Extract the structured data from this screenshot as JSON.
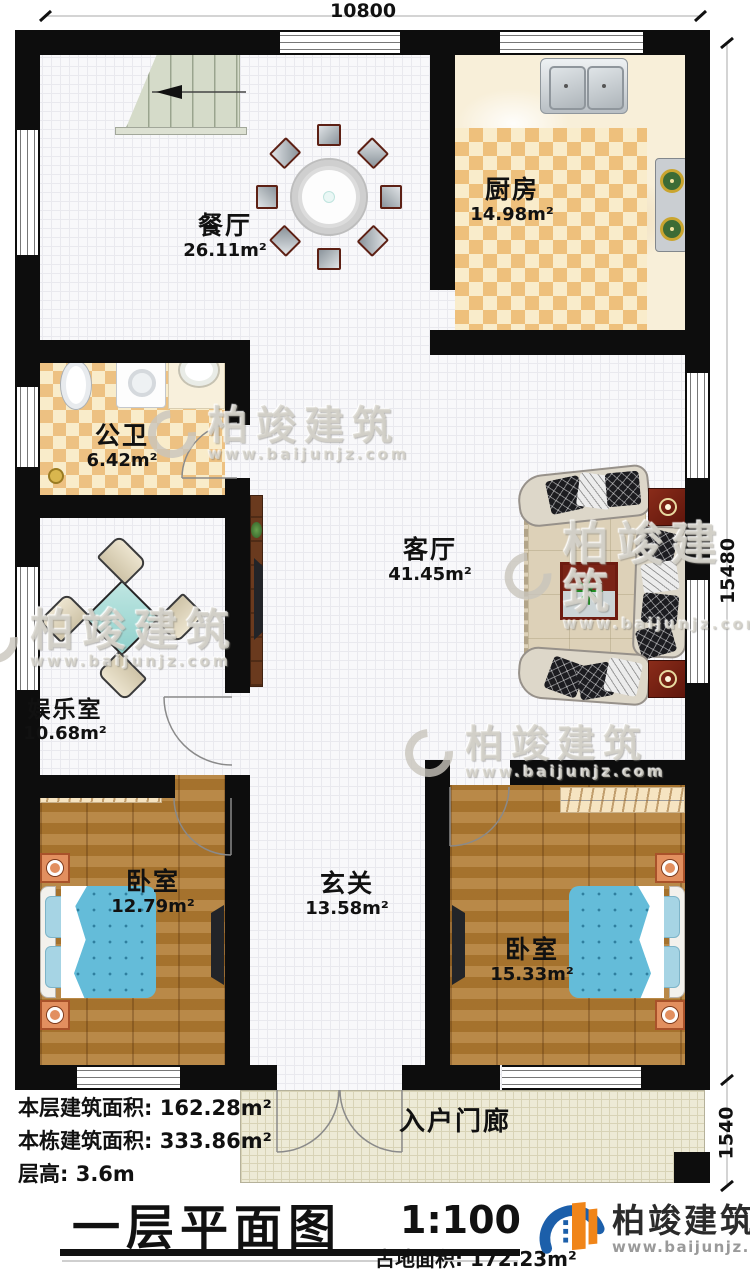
{
  "dimensions": {
    "top": "10800",
    "right": "15480",
    "porch": "1540"
  },
  "rooms": {
    "dining": {
      "name": "餐厅",
      "area": "26.11m²"
    },
    "kitchen": {
      "name": "厨房",
      "area": "14.98m²"
    },
    "bathroom": {
      "name": "公卫",
      "area": "6.42m²"
    },
    "living": {
      "name": "客厅",
      "area": "41.45m²"
    },
    "entertainment": {
      "name": "娱乐室",
      "area": "10.68m²"
    },
    "bedroom_left": {
      "name": "卧室",
      "area": "12.79m²"
    },
    "foyer": {
      "name": "玄关",
      "area": "13.58m²"
    },
    "bedroom_right": {
      "name": "卧室",
      "area": "15.33m²"
    },
    "porch": {
      "name": "入户门廊"
    }
  },
  "info": {
    "floor_area": {
      "label": "本层建筑面积:",
      "value": "162.28m²"
    },
    "building_area": {
      "label": "本栋建筑面积:",
      "value": "333.86m²"
    },
    "floor_height": {
      "label": "层高:",
      "value": "3.6m"
    },
    "land_area": {
      "label": "占地面积:",
      "value": "172.23m²"
    }
  },
  "title": {
    "text": "一层平面图",
    "scale": "1:100"
  },
  "brand": {
    "name": "柏竣建筑",
    "website": "www.baijunjz.com"
  },
  "watermark": {
    "name": "柏竣建筑",
    "website": "www.baijunjz.com"
  },
  "colors": {
    "wall": "#0d0d0d",
    "checker_tan": "#eec07c",
    "checker_cream": "#f9eccb",
    "wood": "#b17c33",
    "bed_blue": "#64bcd9",
    "table_teal": "#9fd8d2",
    "accent_red": "#7a2316",
    "logo_blue": "#1c5faa",
    "logo_orange": "#f08519"
  }
}
